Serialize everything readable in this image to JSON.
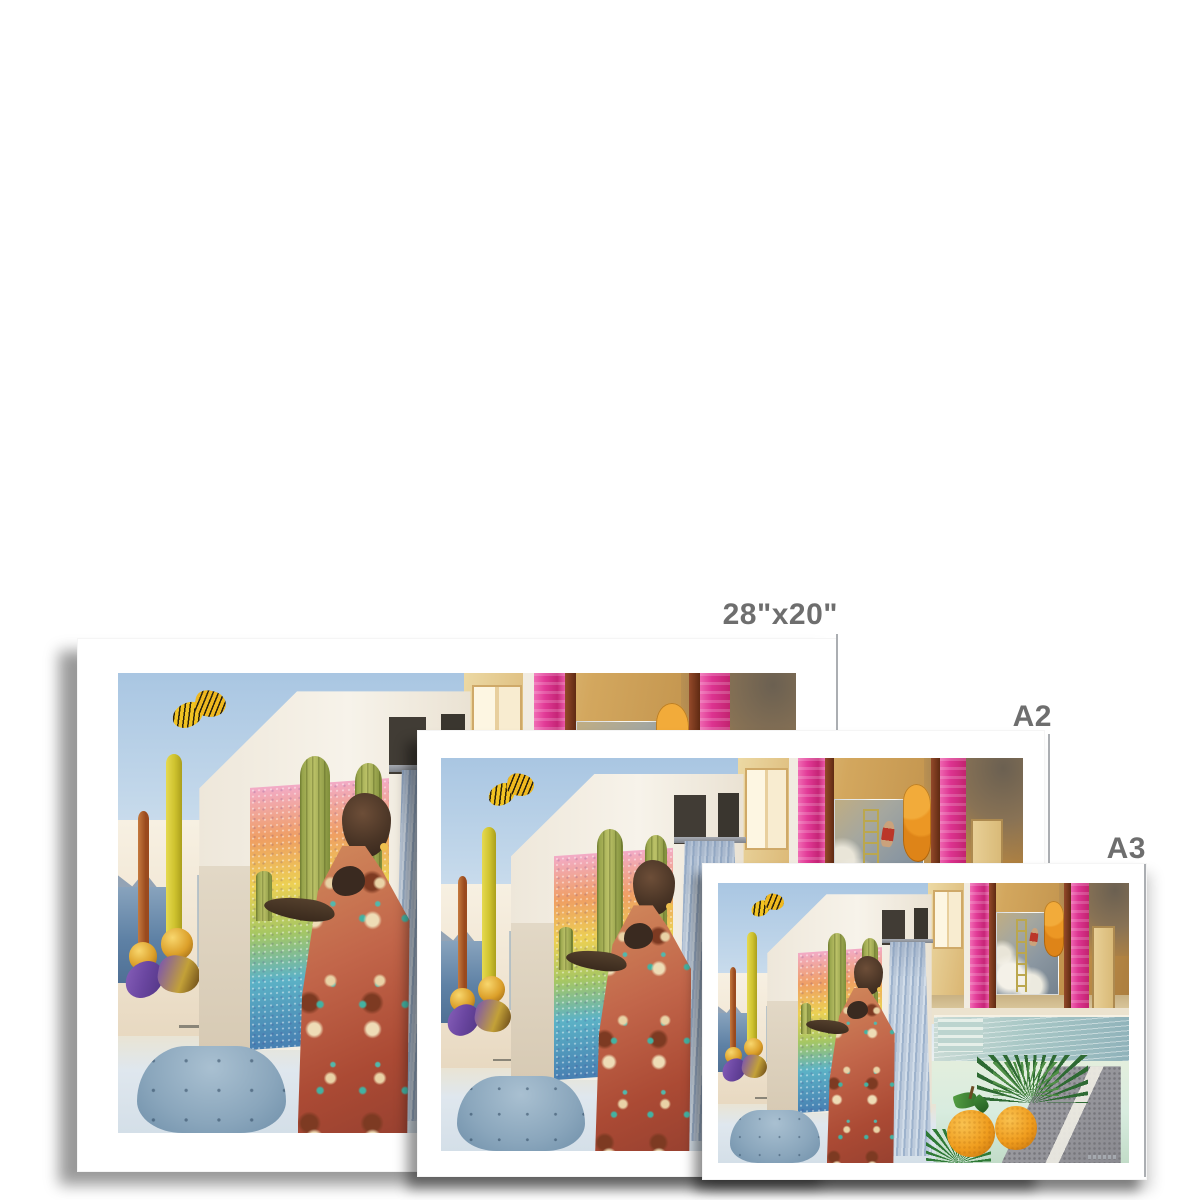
{
  "page": {
    "background": "#ffffff",
    "description": "Unframed art print size comparison mockup"
  },
  "prints": [
    {
      "id": "28x20",
      "label": "28\"x20\""
    },
    {
      "id": "a2",
      "label": "A2"
    },
    {
      "id": "a3",
      "label": "A3"
    }
  ],
  "style": {
    "label_color": "#6e6e6e",
    "guide_line_color": "#abaeb2",
    "paper_color": "#ffffff"
  },
  "artwork": {
    "name": "surreal-pool-collage",
    "colors": {
      "sky": "#b6cde6",
      "gold_room": "#c89d57",
      "magenta_pillar": "#dd3492",
      "mahogany": "#7a3a1d",
      "pool": "#a9c8c6",
      "mint_ground": "#d8ecdf",
      "curtain_blue": "#aabfd8",
      "cactus_green": "#9aa84e",
      "mosaic_pink": "#f2abc7",
      "mosaic_blue": "#477fb2",
      "ottoman_blue": "#8aa6bc",
      "orange_fruit": "#f09d1e",
      "butterfly_yellow": "#f1c322",
      "butterfly_purple": "#6a46a0",
      "candle_yellow": "#d8cc3c",
      "candle_red": "#a85a28",
      "stone_grey": "#95959a"
    }
  }
}
